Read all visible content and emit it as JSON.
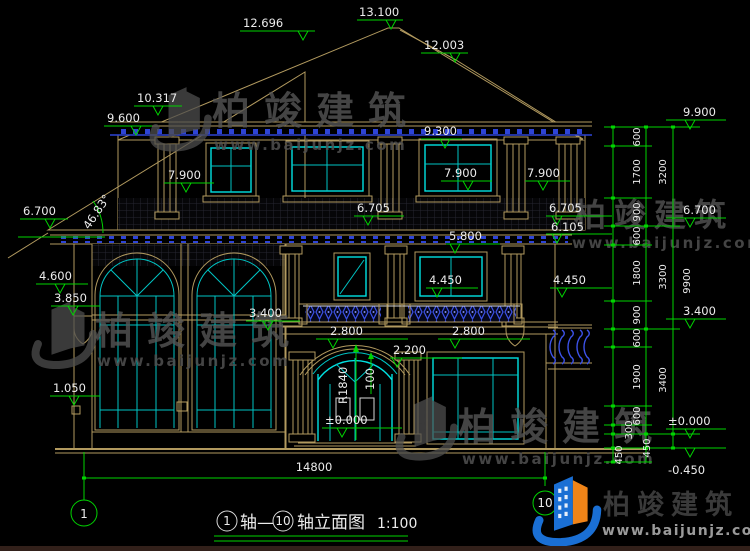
{
  "drawing": {
    "type": "architectural elevation",
    "title_block": {
      "axis_a": "1",
      "joint": "轴—",
      "axis_b": "10",
      "suffix": "轴立面图",
      "scale": "1:100"
    },
    "axis_bubbles": {
      "left": "1",
      "right": "10"
    }
  },
  "brand": {
    "name": "柏竣建筑",
    "url": "www.baijunjz.com"
  },
  "colors": {
    "background": "#000000",
    "dimension_green": "#00d400",
    "wall_tan": "#b29a5f",
    "window_cyan": "#00c4c4",
    "ornament_blue": "#2e44d6",
    "text_white": "#ececec",
    "logo_blue": "#1a6fd4",
    "logo_orange": "#f08418"
  },
  "labels": {
    "e12696": "12.696",
    "e13100": "13.100",
    "e12003": "12.003",
    "e10317": "10.317",
    "e9600": "9.600",
    "e9300": "9.300",
    "e7900l": "7.900",
    "e7900c": "7.900",
    "e7900r": "7.900",
    "e6700l": "6.700",
    "ang": "46.83°",
    "e6705c": "6.705",
    "e6705r": "6.705",
    "e6105r": "6.105",
    "e6700r": "6.700",
    "e9900": "9.900",
    "e5800": "5.800",
    "e4600": "4.600",
    "e4450c": "4.450",
    "e4450r": "4.450",
    "e3850": "3.850",
    "e3400c": "3.400",
    "e3400r": "3.400",
    "e2800l": "2.800",
    "e2800r": "2.800",
    "e2200": "2.200",
    "r1840": "R1840",
    "n100": "100",
    "e1050": "1.050",
    "e0000c": "±0.000",
    "e0000r": "±0.000",
    "em0450": "-0.450",
    "d14800": "14800",
    "v600a": "600",
    "v1700": "1700",
    "v900a": "900",
    "v600b": "600",
    "v1800": "1800",
    "v900b": "900",
    "v600c": "600",
    "v1900": "1900",
    "v600d": "600",
    "v300": "300",
    "v450a": "450",
    "v3200": "3200",
    "v3300": "3300",
    "v3400": "3400",
    "v450b": "450",
    "v9900": "9900"
  }
}
